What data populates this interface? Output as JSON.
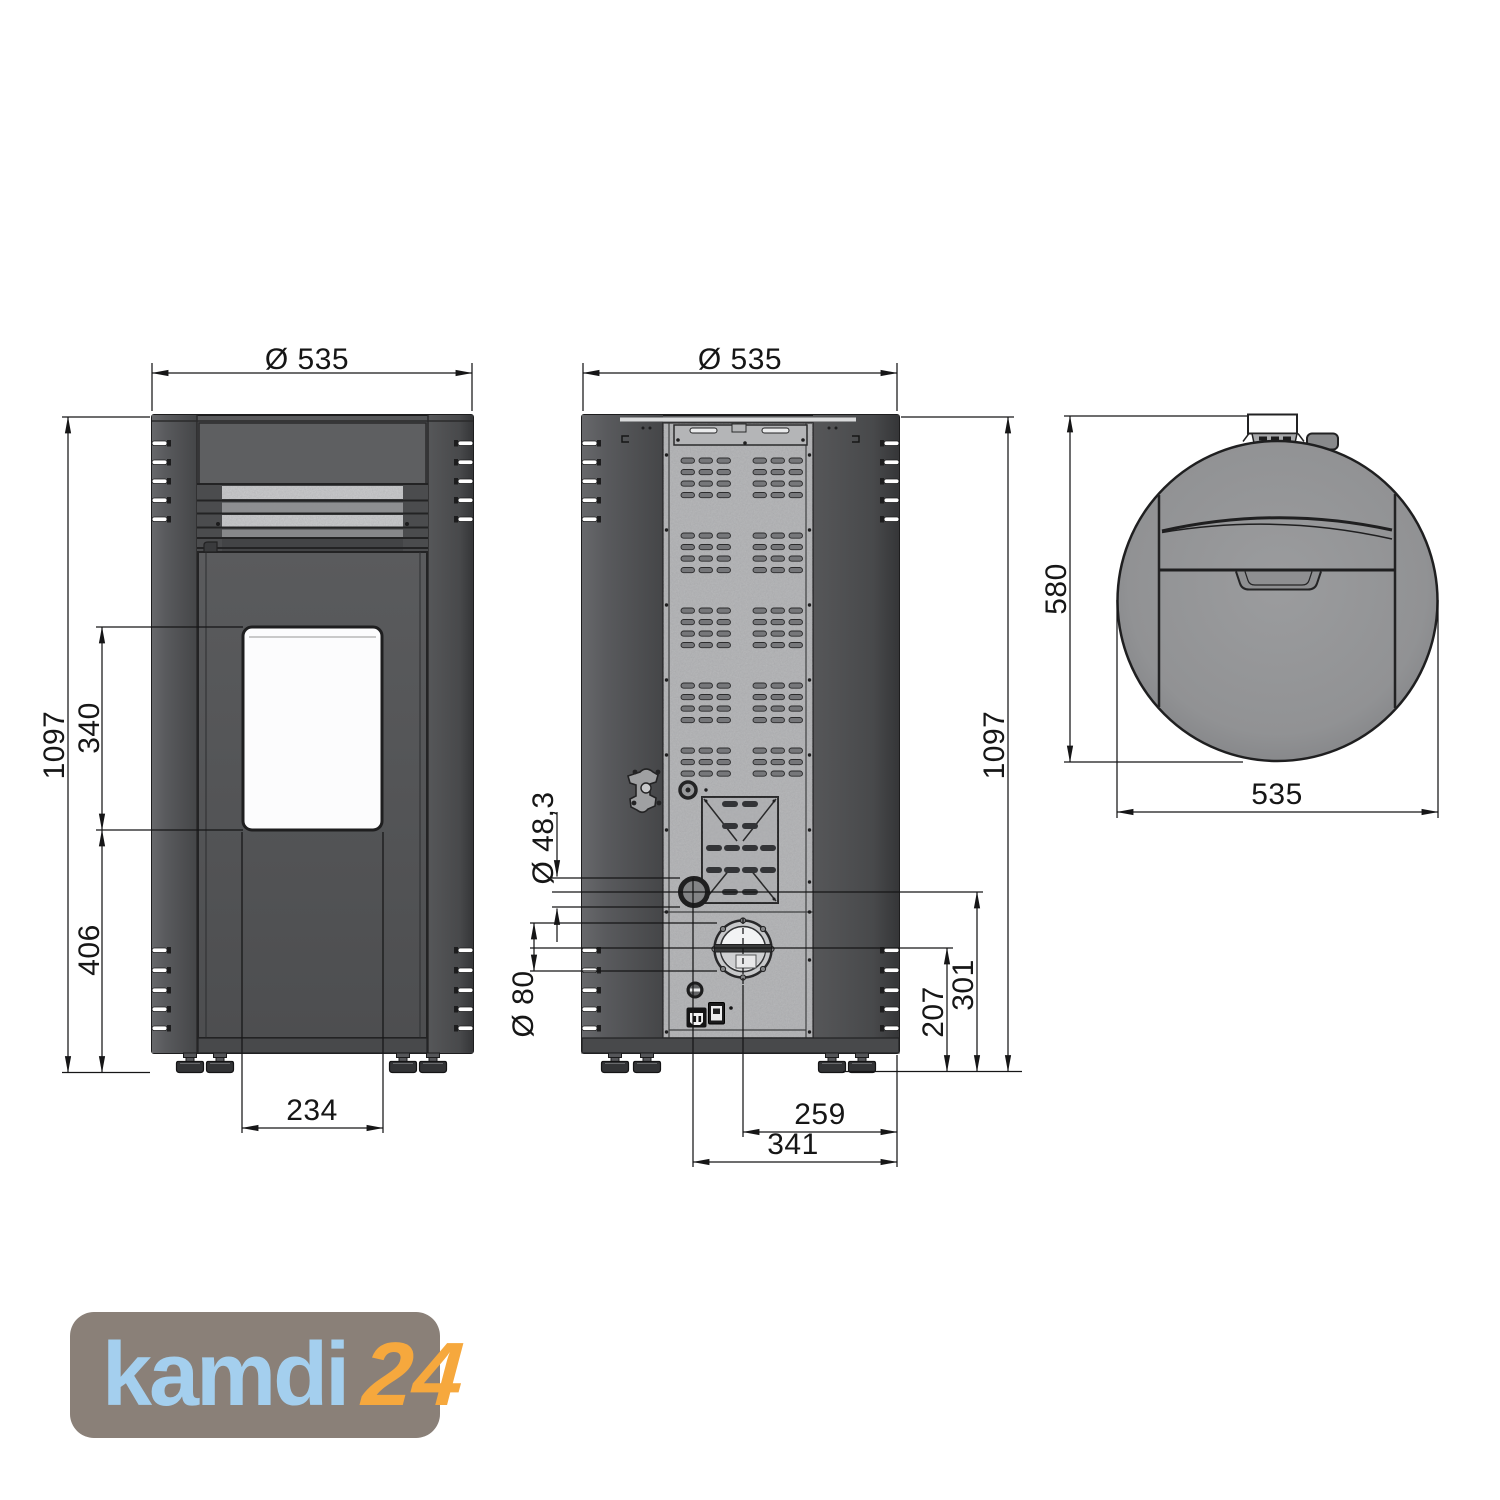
{
  "document": {
    "type": "pellet stove dimensional technical drawing",
    "background": "#FFFFFF",
    "line_color": "#161617"
  },
  "views": {
    "front": {
      "name": "front view",
      "width_label": "Ø 535",
      "height_label": "1097",
      "glass_height_label": "340",
      "base_height_label": "406",
      "glass_width_label": "234"
    },
    "rear": {
      "name": "rear view",
      "width_label": "Ø 535",
      "height_label": "1097",
      "air_pipe_diameter_label": "Ø 48,3",
      "flue_pipe_diameter_label": "Ø 80",
      "flue_center_height_label": "207",
      "air_center_height_label": "301",
      "flue_center_offset_label": "259",
      "air_center_offset_label": "341"
    },
    "top": {
      "name": "top view",
      "depth_label": "580",
      "width_label": "535"
    }
  },
  "logo": {
    "brand": "kamdi",
    "suffix": "24",
    "background_color": "#8A8078",
    "brand_color": "#A4CFEE",
    "suffix_color": "#F6A83D"
  },
  "drawing_colors": {
    "body_grey": "#545557",
    "galvanized_panel": "#AEAFB1",
    "top_view_grey": "#939496",
    "window_white": "#FCFCFD"
  }
}
